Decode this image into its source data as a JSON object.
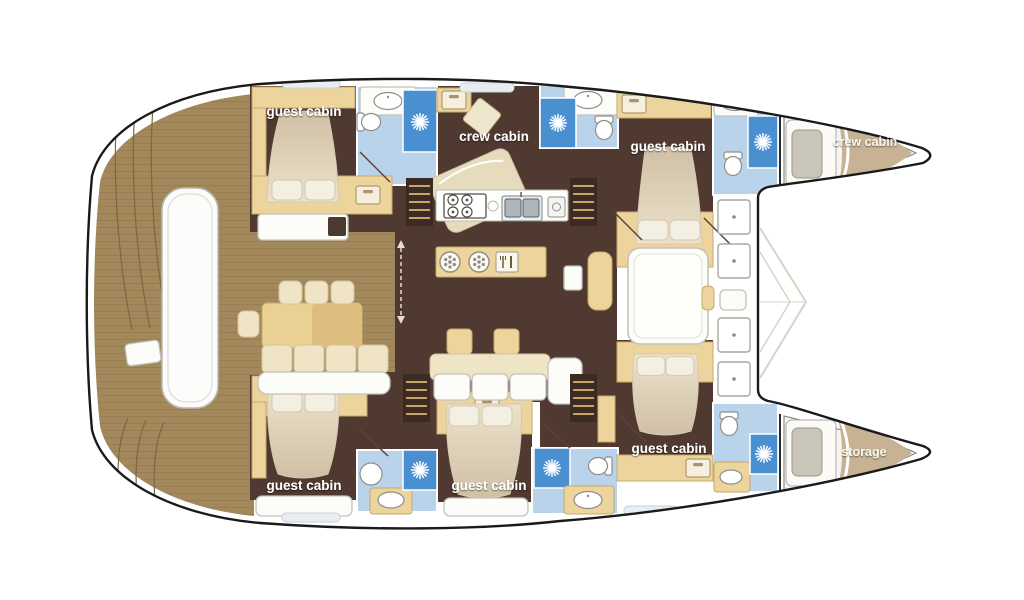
{
  "canvas": {
    "width": 1024,
    "height": 600,
    "background": "#ffffff"
  },
  "colors": {
    "deck_wood": "#a3885c",
    "plank_line": "#8a7047",
    "cabin_floor": "#4f3930",
    "furniture_tan": "#ecd49c",
    "furniture_tan_border": "#c8a96a",
    "bed_cream_light": "#ece1cb",
    "bed_cream_dark": "#cfc0a5",
    "bath_light_blue": "#b9d3eb",
    "shower_blue": "#4a8fd0",
    "bow_bed_tan": "#c7b393",
    "hull_outline": "#1a1a1a",
    "label_text": "#ffffff"
  },
  "labels": {
    "cabin_top_left": "guest cabin",
    "crew_cabin_mid": "crew cabin",
    "cabin_top_right": "guest cabin",
    "crew_cabin_bow": "crew cabin",
    "cabin_bottom_left": "guest cabin",
    "cabin_bottom_mid": "guest cabin",
    "cabin_bottom_right": "guest cabin",
    "storage_bow": "storage"
  },
  "icons": {
    "shower_rose": "starburst",
    "drawer": "cabinet-front",
    "stove": "4-burner-hob",
    "sink": "double-basin",
    "hob_plate": "round-plate",
    "deck_hatch": "square-with-dot"
  }
}
